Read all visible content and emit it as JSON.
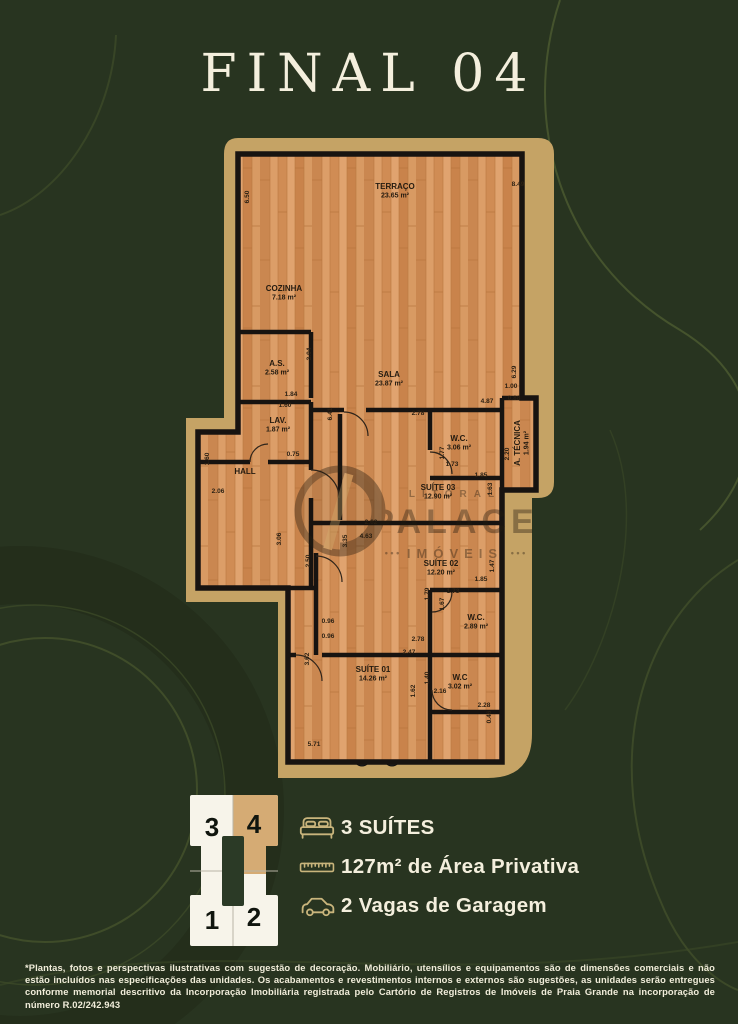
{
  "title": "FINAL 04",
  "plan": {
    "rooms": [
      {
        "name": "TERRAÇO",
        "area": "23.65 m²",
        "x": 395,
        "y": 189
      },
      {
        "name": "COZINHA",
        "area": "7.18 m²",
        "x": 284,
        "y": 291
      },
      {
        "name": "A.S.",
        "area": "2.58 m²",
        "x": 277,
        "y": 366
      },
      {
        "name": "SALA",
        "area": "23.87 m²",
        "x": 389,
        "y": 377
      },
      {
        "name": "LAV.",
        "area": "1.87 m²",
        "x": 278,
        "y": 423
      },
      {
        "name": "HALL",
        "area": "",
        "x": 245,
        "y": 474
      },
      {
        "name": "W.C.",
        "area": "3.06 m²",
        "x": 459,
        "y": 441
      },
      {
        "name": "A. TÉCNICA",
        "area": "1.94 m²",
        "x": 520,
        "y": 443,
        "rot": -90
      },
      {
        "name": "SUÍTE 03",
        "area": "12.90 m²",
        "x": 438,
        "y": 490
      },
      {
        "name": "SUÍTE 02",
        "area": "12.20 m²",
        "x": 441,
        "y": 566
      },
      {
        "name": "W.C.",
        "area": "2.89 m²",
        "x": 476,
        "y": 620
      },
      {
        "name": "SUÍTE 01",
        "area": "14.26 m²",
        "x": 373,
        "y": 672
      },
      {
        "name": "W.C",
        "area": "3.02 m²",
        "x": 460,
        "y": 680
      }
    ],
    "dimensions": [
      [
        "8.49",
        518,
        186,
        0
      ],
      [
        "6.50",
        249,
        197,
        1
      ],
      [
        "3.04",
        311,
        354,
        1
      ],
      [
        "1.84",
        291,
        396,
        0
      ],
      [
        "6.29",
        516,
        372,
        1
      ],
      [
        "1.00",
        511,
        388,
        0
      ],
      [
        "0.88",
        514,
        400,
        0
      ],
      [
        "4.87",
        487,
        403,
        0
      ],
      [
        "1.60",
        285,
        407,
        0
      ],
      [
        "2.78",
        418,
        415,
        0
      ],
      [
        "6.41",
        332,
        414,
        1
      ],
      [
        "0.75",
        293,
        456,
        0
      ],
      [
        "1.60",
        209,
        459,
        1
      ],
      [
        "2.06",
        218,
        493,
        0
      ],
      [
        "1.77",
        444,
        453,
        1
      ],
      [
        "1.73",
        452,
        466,
        0
      ],
      [
        "2.20",
        509,
        454,
        1
      ],
      [
        "1.85",
        481,
        477,
        0
      ],
      [
        "1.63",
        492,
        489,
        1
      ],
      [
        "3.06",
        281,
        539,
        1
      ],
      [
        "2.50",
        310,
        561,
        1
      ],
      [
        "3.35",
        347,
        541,
        1
      ],
      [
        "2.62",
        371,
        524,
        0
      ],
      [
        "4.63",
        366,
        538,
        0
      ],
      [
        "1.47",
        494,
        566,
        1
      ],
      [
        "1.85",
        481,
        581,
        0
      ],
      [
        "1.79",
        429,
        594,
        1
      ],
      [
        "1.73",
        453,
        593,
        0
      ],
      [
        "1.67",
        444,
        604,
        1
      ],
      [
        "0.96",
        328,
        623,
        0
      ],
      [
        "0.96",
        328,
        638,
        0
      ],
      [
        "2.78",
        418,
        641,
        0
      ],
      [
        "2.47",
        409,
        654,
        0
      ],
      [
        "3.62",
        309,
        659,
        1
      ],
      [
        "1.40",
        429,
        678,
        1
      ],
      [
        "1.62",
        415,
        691,
        1
      ],
      [
        "2.16",
        440,
        693,
        0
      ],
      [
        "2.28",
        484,
        707,
        0
      ],
      [
        "5.71",
        314,
        746,
        0
      ],
      [
        "0.46",
        491,
        717,
        1
      ]
    ],
    "watermark": {
      "top": "LITORAL",
      "main": "PALACE",
      "bottom": "IMÓVEIS",
      "dots": "• • •"
    }
  },
  "key_diagram": {
    "units": [
      {
        "label": "3",
        "highlighted": false
      },
      {
        "label": "4",
        "highlighted": true
      },
      {
        "label": "1",
        "highlighted": false
      },
      {
        "label": "2",
        "highlighted": false
      }
    ]
  },
  "features": [
    {
      "icon": "bed-icon",
      "label": "3 SUÍTES"
    },
    {
      "icon": "ruler-icon",
      "label": "127m² de Área Privativa"
    },
    {
      "icon": "car-icon",
      "label": "2 Vagas de Garagem"
    }
  ],
  "disclaimer": "*Plantas, fotos e perspectivas ilustrativas com sugestão de decoração. Mobiliário, utensílios e equipamentos são de dimensões comerciais e não estão incluídos nas especificações das unidades. Os acabamentos e revestimentos internos e externos são sugestões, as unidades serão entregues conforme memorial descritivo da Incorporação Imobiliária registrada pelo Cartório de Registros de Imóveis de Praia Grande na incorporação de número R.02/242.943",
  "colors": {
    "background": "#283420",
    "accent_gold": "#c5a365",
    "cream": "#f4efdd",
    "unit_highlight": "#d5ab74",
    "wood": "#d39259"
  }
}
